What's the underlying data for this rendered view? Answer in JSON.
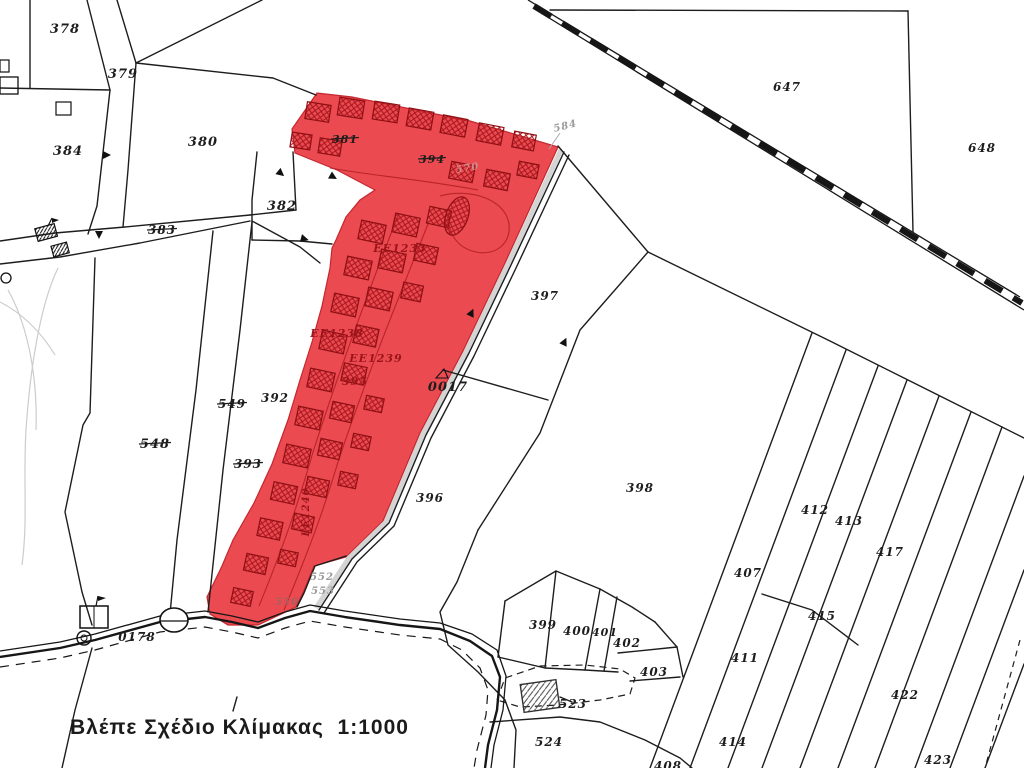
{
  "caption": {
    "text": "Βλέπε Σχέδιο Κλίμακας  1:1000"
  },
  "colors": {
    "highlight": "#ea4a50",
    "highlight_edge": "#c3282e",
    "hatch": "#a8171d",
    "ink": "#1d1d1d",
    "gray_label": "#9a9a9a",
    "red_label": "#9c141a",
    "faded_550": "#a85f5f",
    "faded_570": "#d18f8f"
  },
  "labels": [
    {
      "t": "378",
      "x": 65,
      "y": 33,
      "s": 13
    },
    {
      "t": "379",
      "x": 123,
      "y": 78,
      "s": 13
    },
    {
      "t": "384",
      "x": 68,
      "y": 155,
      "s": 13
    },
    {
      "t": "380",
      "x": 203,
      "y": 146,
      "s": 13
    },
    {
      "t": "383",
      "x": 162,
      "y": 234,
      "s": 12,
      "strike": true
    },
    {
      "t": "382",
      "x": 282,
      "y": 210,
      "s": 13
    },
    {
      "t": "381",
      "x": 345,
      "y": 143,
      "s": 11,
      "strike": true
    },
    {
      "t": "394",
      "x": 432,
      "y": 163,
      "s": 11,
      "strike": true
    },
    {
      "t": "647",
      "x": 787,
      "y": 91,
      "s": 12
    },
    {
      "t": "648",
      "x": 982,
      "y": 152,
      "s": 12
    },
    {
      "t": "397",
      "x": 545,
      "y": 300,
      "s": 12
    },
    {
      "t": "398",
      "x": 640,
      "y": 492,
      "s": 12
    },
    {
      "t": "392",
      "x": 275,
      "y": 402,
      "s": 12
    },
    {
      "t": "549",
      "x": 232,
      "y": 408,
      "s": 12,
      "strike": true,
      "w": 900
    },
    {
      "t": "548",
      "x": 155,
      "y": 448,
      "s": 13,
      "strike": true,
      "w": 900
    },
    {
      "t": "393",
      "x": 248,
      "y": 468,
      "s": 12,
      "strike": true
    },
    {
      "t": "396",
      "x": 430,
      "y": 502,
      "s": 12
    },
    {
      "t": "0017",
      "x": 448,
      "y": 391,
      "s": 13
    },
    {
      "t": "0178",
      "x": 137,
      "y": 641,
      "s": 12
    },
    {
      "t": "399",
      "x": 543,
      "y": 629,
      "s": 12
    },
    {
      "t": "400",
      "x": 577,
      "y": 635,
      "s": 12
    },
    {
      "t": "401",
      "x": 605,
      "y": 636,
      "s": 11
    },
    {
      "t": "402",
      "x": 627,
      "y": 647,
      "s": 12
    },
    {
      "t": "403",
      "x": 654,
      "y": 676,
      "s": 12
    },
    {
      "t": "523",
      "x": 573,
      "y": 708,
      "s": 12
    },
    {
      "t": "524",
      "x": 549,
      "y": 746,
      "s": 12
    },
    {
      "t": "407",
      "x": 748,
      "y": 577,
      "s": 12
    },
    {
      "t": "411",
      "x": 745,
      "y": 662,
      "s": 12
    },
    {
      "t": "412",
      "x": 815,
      "y": 514,
      "s": 12
    },
    {
      "t": "413",
      "x": 849,
      "y": 525,
      "s": 12
    },
    {
      "t": "415",
      "x": 822,
      "y": 620,
      "s": 12
    },
    {
      "t": "414",
      "x": 733,
      "y": 746,
      "s": 12
    },
    {
      "t": "417",
      "x": 890,
      "y": 556,
      "s": 12
    },
    {
      "t": "422",
      "x": 905,
      "y": 699,
      "s": 12
    },
    {
      "t": "423",
      "x": 938,
      "y": 764,
      "s": 12
    },
    {
      "t": "408",
      "x": 668,
      "y": 770,
      "s": 12
    },
    {
      "t": "EE1233",
      "x": 400,
      "y": 252,
      "s": 11,
      "k": "red"
    },
    {
      "t": "EE1238",
      "x": 337,
      "y": 337,
      "s": 11,
      "k": "red"
    },
    {
      "t": "EE1239",
      "x": 376,
      "y": 362,
      "s": 11,
      "k": "red"
    },
    {
      "t": "EE1240",
      "x": 309,
      "y": 512,
      "s": 10,
      "k": "red",
      "rot": -90
    },
    {
      "t": "395",
      "x": 355,
      "y": 385,
      "s": 11,
      "k": "red"
    },
    {
      "t": "584",
      "x": 566,
      "y": 129,
      "s": 10,
      "k": "gray",
      "rot": -14
    },
    {
      "t": "552",
      "x": 322,
      "y": 580,
      "s": 10,
      "k": "gray"
    },
    {
      "t": "553",
      "x": 323,
      "y": 594,
      "s": 10,
      "k": "gray"
    },
    {
      "t": "550",
      "x": 287,
      "y": 605,
      "s": 10,
      "k": "f550"
    },
    {
      "t": "570",
      "x": 468,
      "y": 171,
      "s": 10,
      "k": "f570",
      "rot": -10
    }
  ]
}
